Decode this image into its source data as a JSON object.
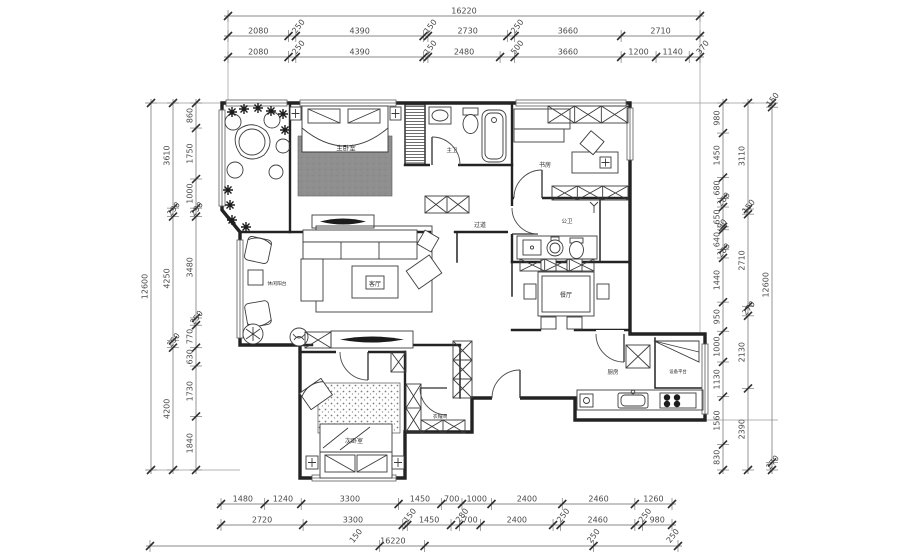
{
  "drawing": {
    "type": "residential-floor-plan",
    "rooms": {
      "master_bedroom": "主卧室",
      "master_bath": "主卫",
      "study": "书房",
      "hallway": "过道",
      "public_bath": "公卫",
      "dining": "餐厅",
      "living": "客厅",
      "leisure_balcony": "休闲阳台",
      "second_bedroom": "次卧室",
      "cloakroom": "衣帽间",
      "kitchen": "厨房",
      "equipment_platform": "设备平台"
    },
    "dims": {
      "top_total": "16220",
      "top_row1": [
        "2080",
        "250",
        "4390",
        "150",
        "2730",
        "250",
        "3660",
        "2710"
      ],
      "top_row2": [
        "2080",
        "250",
        "4390",
        "150",
        "2480",
        "500",
        "3660",
        "1200",
        "1140",
        "370"
      ],
      "bottom_row1": [
        "1480",
        "1240",
        "3300",
        "1450",
        "700",
        "1000",
        "2400",
        "2460",
        "1260"
      ],
      "bottom_row2": [
        "2720",
        "3300",
        "150",
        "1450",
        "280",
        "700",
        "2400",
        "250",
        "2460",
        "250",
        "980"
      ],
      "bottom_row3": [
        "150",
        "16220",
        "250",
        "250"
      ],
      "left_inner": [
        "860",
        "1750",
        "1000",
        "290",
        "3480",
        "250",
        "770",
        "630",
        "1730",
        "1840"
      ],
      "left_middle": [
        "3610",
        "290",
        "4250",
        "250",
        "4200"
      ],
      "left_total": "12600",
      "right_inner": [
        "980",
        "1450",
        "680",
        "280",
        "650",
        "90",
        "640",
        "280",
        "1440",
        "950",
        "1000",
        "1130",
        "1560",
        "830"
      ],
      "right_middle": [
        "3110",
        "150",
        "2710",
        "270",
        "2130",
        "2390"
      ],
      "right_outer": [
        "150",
        "12600",
        "270"
      ]
    },
    "colors": {
      "wall": "#232323",
      "dimension_text": "#4a4a4a",
      "rug": "#8f8f8f",
      "dark_fill": "#1c1c1c",
      "background": "#ffffff"
    }
  }
}
